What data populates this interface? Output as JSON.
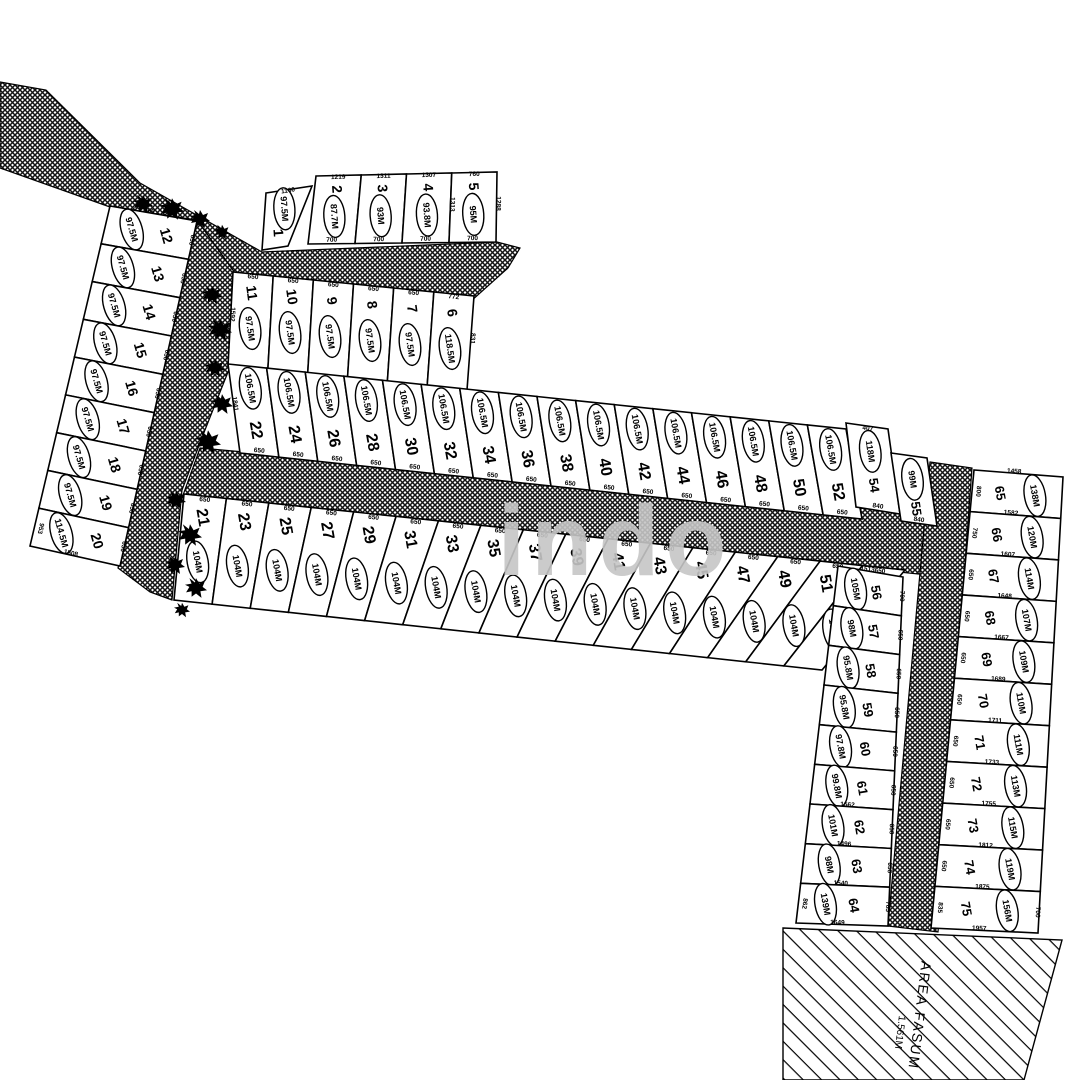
{
  "watermark": "indo",
  "area_fasum": {
    "label": "AREA FASUM",
    "area": "1.561M"
  },
  "rows": [
    {
      "id": "r1",
      "lots": [
        {
          "n": "1",
          "a": "97.5M",
          "d": [
            [
              "T",
              "1160"
            ]
          ]
        }
      ]
    },
    {
      "id": "r2_5",
      "lots": [
        {
          "n": "2",
          "a": "87.7M",
          "d": [
            [
              "T",
              "1219"
            ],
            [
              "B",
              "700"
            ]
          ]
        },
        {
          "n": "3",
          "a": "93M",
          "d": [
            [
              "T",
              "1311"
            ],
            [
              "B",
              "700"
            ]
          ]
        },
        {
          "n": "4",
          "a": "93.8M",
          "d": [
            [
              "T",
              "1307"
            ],
            [
              "B",
              "700"
            ]
          ]
        },
        {
          "n": "5",
          "a": "95M",
          "d": [
            [
              "T",
              "760"
            ],
            [
              "L",
              "1313"
            ],
            [
              "R",
              "1288"
            ],
            [
              "B",
              "700"
            ]
          ]
        }
      ]
    },
    {
      "id": "r6_11",
      "lots": [
        {
          "n": "11",
          "a": "97.5M",
          "d": [
            [
              "T",
              "650"
            ],
            [
              "L",
              "1592"
            ]
          ]
        },
        {
          "n": "10",
          "a": "97.5M",
          "d": [
            [
              "T",
              "650"
            ]
          ]
        },
        {
          "n": "9",
          "a": "97.5M",
          "d": [
            [
              "T",
              "650"
            ]
          ]
        },
        {
          "n": "8",
          "a": "97.5M",
          "d": [
            [
              "T",
              "650"
            ]
          ]
        },
        {
          "n": "7",
          "a": "97.5M",
          "d": [
            [
              "T",
              "650"
            ]
          ]
        },
        {
          "n": "6",
          "a": "118.5M",
          "d": [
            [
              "T",
              "772"
            ],
            [
              "R",
              "831"
            ]
          ]
        }
      ]
    },
    {
      "id": "r12_20",
      "lots": [
        {
          "n": "12",
          "a": "97.5M",
          "d": [
            [
              "L",
              "760"
            ],
            [
              "B",
              "650"
            ]
          ]
        },
        {
          "n": "13",
          "a": "97.5M",
          "d": [
            [
              "B",
              "650"
            ]
          ]
        },
        {
          "n": "14",
          "a": "97.5M",
          "d": [
            [
              "B",
              "650"
            ]
          ]
        },
        {
          "n": "15",
          "a": "97.5M",
          "d": [
            [
              "B",
              "650"
            ]
          ]
        },
        {
          "n": "16",
          "a": "97.5M",
          "d": [
            [
              "B",
              "650"
            ]
          ]
        },
        {
          "n": "17",
          "a": "97.5M",
          "d": [
            [
              "B",
              "650"
            ]
          ]
        },
        {
          "n": "18",
          "a": "97.5M",
          "d": [
            [
              "B",
              "650"
            ]
          ]
        },
        {
          "n": "19",
          "a": "97.5M",
          "d": [
            [
              "B",
              "650"
            ]
          ]
        },
        {
          "n": "20",
          "a": "114.5M",
          "d": [
            [
              "T",
              "953"
            ],
            [
              "R",
              "1508"
            ],
            [
              "B",
              "650"
            ]
          ]
        }
      ]
    },
    {
      "id": "r22_52",
      "lots": [
        {
          "n": "22",
          "a": "106.5M",
          "d": [
            [
              "L",
              "1841"
            ],
            [
              "B",
              "650"
            ]
          ]
        },
        {
          "n": "24",
          "a": "106.5M",
          "d": [
            [
              "B",
              "650"
            ]
          ]
        },
        {
          "n": "26",
          "a": "106.5M",
          "d": [
            [
              "B",
              "650"
            ]
          ]
        },
        {
          "n": "28",
          "a": "106.5M",
          "d": [
            [
              "B",
              "650"
            ]
          ]
        },
        {
          "n": "30",
          "a": "106.5M",
          "d": [
            [
              "B",
              "650"
            ]
          ]
        },
        {
          "n": "32",
          "a": "106.5M",
          "d": [
            [
              "B",
              "650"
            ]
          ]
        },
        {
          "n": "34",
          "a": "106.5M",
          "d": [
            [
              "B",
              "650"
            ]
          ]
        },
        {
          "n": "36",
          "a": "106.5M",
          "d": [
            [
              "B",
              "650"
            ]
          ]
        },
        {
          "n": "38",
          "a": "106.5M",
          "d": [
            [
              "B",
              "650"
            ]
          ]
        },
        {
          "n": "40",
          "a": "106.5M",
          "d": [
            [
              "B",
              "650"
            ]
          ]
        },
        {
          "n": "42",
          "a": "106.5M",
          "d": [
            [
              "B",
              "650"
            ]
          ]
        },
        {
          "n": "44",
          "a": "106.5M",
          "d": [
            [
              "B",
              "650"
            ]
          ]
        },
        {
          "n": "46",
          "a": "106.5M",
          "d": [
            [
              "B",
              "650"
            ]
          ]
        },
        {
          "n": "48",
          "a": "106.5M",
          "d": [
            [
              "B",
              "650"
            ]
          ]
        },
        {
          "n": "50",
          "a": "106.5M",
          "d": [
            [
              "B",
              "650"
            ]
          ]
        },
        {
          "n": "52",
          "a": "106.5M",
          "d": [
            [
              "B",
              "650"
            ]
          ]
        }
      ]
    },
    {
      "id": "r54",
      "lots": [
        {
          "n": "54",
          "a": "118M",
          "d": [
            [
              "T",
              "407"
            ],
            [
              "R",
              "983"
            ],
            [
              "B",
              "840"
            ]
          ]
        }
      ]
    },
    {
      "id": "r55",
      "lots": [
        {
          "n": "55",
          "a": "99M",
          "d": [
            [
              "B",
              "840"
            ]
          ]
        }
      ]
    },
    {
      "id": "r21_53",
      "lots": [
        {
          "n": "21",
          "a": "104M",
          "d": [
            [
              "T",
              "650"
            ]
          ]
        },
        {
          "n": "23",
          "a": "104M",
          "d": [
            [
              "T",
              "650"
            ]
          ]
        },
        {
          "n": "25",
          "a": "104M",
          "d": [
            [
              "T",
              "650"
            ]
          ]
        },
        {
          "n": "27",
          "a": "104M",
          "d": [
            [
              "T",
              "650"
            ]
          ]
        },
        {
          "n": "29",
          "a": "104M",
          "d": [
            [
              "T",
              "650"
            ]
          ]
        },
        {
          "n": "31",
          "a": "104M",
          "d": [
            [
              "T",
              "650"
            ]
          ]
        },
        {
          "n": "33",
          "a": "104M",
          "d": [
            [
              "T",
              "650"
            ]
          ]
        },
        {
          "n": "35",
          "a": "104M",
          "d": [
            [
              "T",
              "650"
            ]
          ]
        },
        {
          "n": "37",
          "a": "104M",
          "d": [
            [
              "T",
              "650"
            ]
          ]
        },
        {
          "n": "39",
          "a": "104M",
          "d": [
            [
              "T",
              "650"
            ]
          ]
        },
        {
          "n": "41",
          "a": "104M",
          "d": [
            [
              "T",
              "650"
            ]
          ]
        },
        {
          "n": "43",
          "a": "104M",
          "d": [
            [
              "T",
              "650"
            ]
          ]
        },
        {
          "n": "45",
          "a": "104M",
          "d": [
            [
              "T",
              "650"
            ]
          ]
        },
        {
          "n": "47",
          "a": "104M",
          "d": [
            [
              "T",
              "650"
            ]
          ]
        },
        {
          "n": "49",
          "a": "104M",
          "d": [
            [
              "T",
              "650"
            ]
          ]
        },
        {
          "n": "51",
          "a": "104M",
          "d": [
            [
              "T",
              "650"
            ]
          ]
        },
        {
          "n": "53",
          "a": "104M",
          "d": [
            [
              "T",
              "650"
            ]
          ]
        }
      ]
    },
    {
      "id": "r56_64",
      "lots": [
        {
          "n": "56",
          "a": "105M",
          "d": [
            [
              "L",
              "1513"
            ],
            [
              "B",
              "700"
            ]
          ]
        },
        {
          "n": "57",
          "a": "98M",
          "d": [
            [
              "B",
              "650"
            ]
          ]
        },
        {
          "n": "58",
          "a": "95.8M",
          "d": [
            [
              "B",
              "650"
            ]
          ]
        },
        {
          "n": "59",
          "a": "95.8M",
          "d": [
            [
              "B",
              "650"
            ]
          ]
        },
        {
          "n": "60",
          "a": "97.8M",
          "d": [
            [
              "B",
              "650"
            ]
          ]
        },
        {
          "n": "61",
          "a": "99.8M",
          "d": [
            [
              "B",
              "650"
            ]
          ]
        },
        {
          "n": "62",
          "a": "101M",
          "d": [
            [
              "L",
              "1562"
            ],
            [
              "B",
              "650"
            ]
          ]
        },
        {
          "n": "63",
          "a": "98M",
          "d": [
            [
              "L",
              "1496"
            ],
            [
              "B",
              "650"
            ]
          ]
        },
        {
          "n": "64",
          "a": "139M",
          "d": [
            [
              "L",
              "1540"
            ],
            [
              "R",
              "1649"
            ],
            [
              "T",
              "862"
            ],
            [
              "B",
              "785"
            ]
          ]
        }
      ]
    },
    {
      "id": "r65_75",
      "lots": [
        {
          "n": "65",
          "a": "138M",
          "d": [
            [
              "L",
              "1458"
            ],
            [
              "T",
              "800"
            ],
            [
              "R",
              "1582"
            ]
          ]
        },
        {
          "n": "66",
          "a": "120M",
          "d": [
            [
              "T",
              "750"
            ],
            [
              "R",
              "1607"
            ]
          ]
        },
        {
          "n": "67",
          "a": "114M",
          "d": [
            [
              "T",
              "650"
            ],
            [
              "R",
              "1648"
            ]
          ]
        },
        {
          "n": "68",
          "a": "107M",
          "d": [
            [
              "T",
              "650"
            ],
            [
              "R",
              "1667"
            ]
          ]
        },
        {
          "n": "69",
          "a": "109M",
          "d": [
            [
              "T",
              "650"
            ],
            [
              "R",
              "1689"
            ]
          ]
        },
        {
          "n": "70",
          "a": "110M",
          "d": [
            [
              "T",
              "650"
            ],
            [
              "R",
              "1711"
            ]
          ]
        },
        {
          "n": "71",
          "a": "111M",
          "d": [
            [
              "T",
              "650"
            ],
            [
              "R",
              "1733"
            ]
          ]
        },
        {
          "n": "72",
          "a": "113M",
          "d": [
            [
              "T",
              "650"
            ],
            [
              "R",
              "1755"
            ]
          ]
        },
        {
          "n": "73",
          "a": "115M",
          "d": [
            [
              "T",
              "650"
            ],
            [
              "R",
              "1812"
            ]
          ]
        },
        {
          "n": "74",
          "a": "119M",
          "d": [
            [
              "T",
              "650"
            ],
            [
              "R",
              "1875"
            ]
          ]
        },
        {
          "n": "75",
          "a": "156M",
          "d": [
            [
              "T",
              "835"
            ],
            [
              "R",
              "1957"
            ],
            [
              "B",
              "700"
            ]
          ]
        }
      ]
    }
  ]
}
